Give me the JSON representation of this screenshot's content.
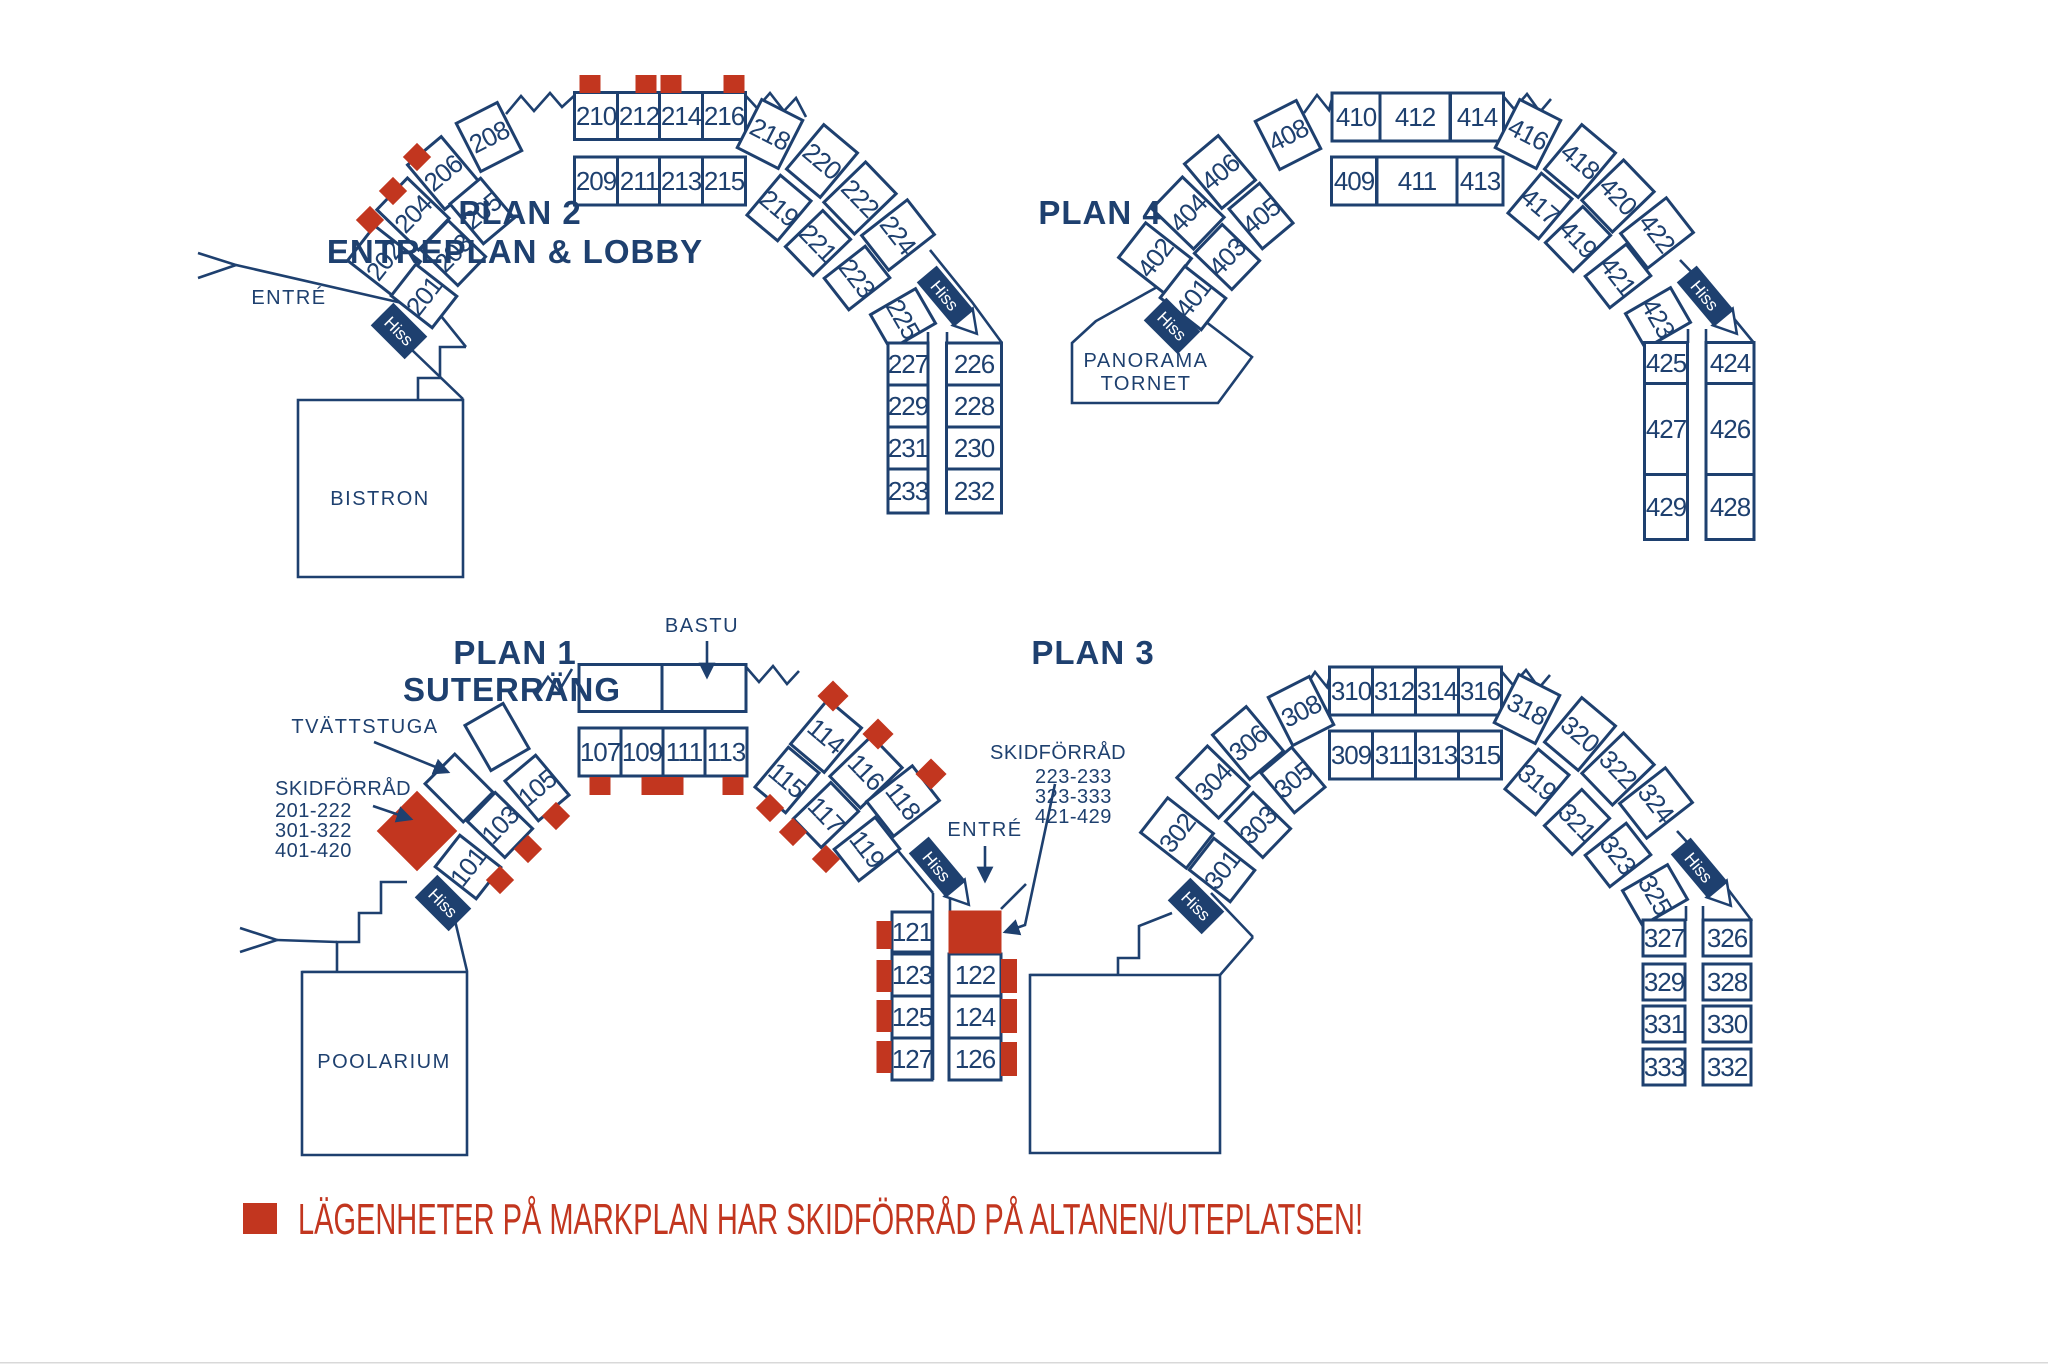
{
  "colors": {
    "navy": "#1e406f",
    "red": "#c2361f",
    "background": "#ffffff"
  },
  "hiss_label": "Hiss",
  "legend": {
    "marker_color": "#c2361f",
    "text": "LÄGENHETER PÅ MARKPLAN HAR SKIDFÖRRÅD PÅ ALTANEN/UTEPLATSEN!"
  },
  "plans": {
    "plan2": {
      "title": "PLAN 2",
      "subtitle": "ENTRÉPLAN & LOBBY",
      "labels": {
        "entrance": "ENTRÉ",
        "bistro": "BISTRON"
      },
      "rooms": [
        "202",
        "204",
        "206",
        "208",
        "210",
        "212",
        "214",
        "216",
        "218",
        "220",
        "222",
        "224",
        "201",
        "203",
        "205",
        "209",
        "211",
        "213",
        "215",
        "219",
        "221",
        "223",
        "225",
        "227",
        "229",
        "231",
        "233",
        "226",
        "228",
        "230",
        "232"
      ],
      "red_marked_rooms": [
        "202",
        "204",
        "206",
        "210",
        "212",
        "214",
        "216"
      ]
    },
    "plan4": {
      "title": "PLAN 4",
      "labels": {
        "tower_line1": "PANORAMA",
        "tower_line2": "TORNET"
      },
      "rooms": [
        "402",
        "404",
        "406",
        "408",
        "410",
        "412",
        "414",
        "416",
        "418",
        "420",
        "422",
        "401",
        "403",
        "405",
        "409",
        "411",
        "413",
        "417",
        "419",
        "421",
        "423",
        "425",
        "427",
        "429",
        "424",
        "426",
        "428"
      ],
      "red_marked_rooms": []
    },
    "plan1": {
      "title": "PLAN 1",
      "subtitle": "SUTERRÄNG",
      "labels": {
        "sauna": "BASTU",
        "laundry": "TVÄTTSTUGA",
        "entrance": "ENTRÉ",
        "pool": "POOLARIUM",
        "ski_storage_left": {
          "title": "SKIDFÖRRÅD",
          "items": [
            "201-222",
            "301-322",
            "401-420"
          ]
        },
        "ski_storage_right": {
          "title": "SKIDFÖRRÅD",
          "items": [
            "223-233",
            "323-333",
            "421-429"
          ]
        }
      },
      "rooms": [
        "101",
        "103",
        "105",
        "107",
        "109",
        "111",
        "113",
        "114",
        "116",
        "118",
        "115",
        "117",
        "119",
        "121",
        "123",
        "125",
        "127",
        "122",
        "124",
        "126"
      ],
      "red_marked_rooms": [
        "101",
        "103",
        "105",
        "107",
        "109",
        "111",
        "113",
        "114",
        "115",
        "116",
        "117",
        "118",
        "119",
        "121",
        "122",
        "123",
        "124",
        "125",
        "126",
        "127"
      ]
    },
    "plan3": {
      "title": "PLAN 3",
      "rooms": [
        "302",
        "304",
        "306",
        "308",
        "310",
        "312",
        "314",
        "316",
        "318",
        "320",
        "322",
        "324",
        "301",
        "303",
        "305",
        "309",
        "311",
        "313",
        "315",
        "319",
        "321",
        "323",
        "325",
        "327",
        "329",
        "331",
        "333",
        "326",
        "328",
        "330",
        "332"
      ],
      "red_marked_rooms": []
    }
  }
}
